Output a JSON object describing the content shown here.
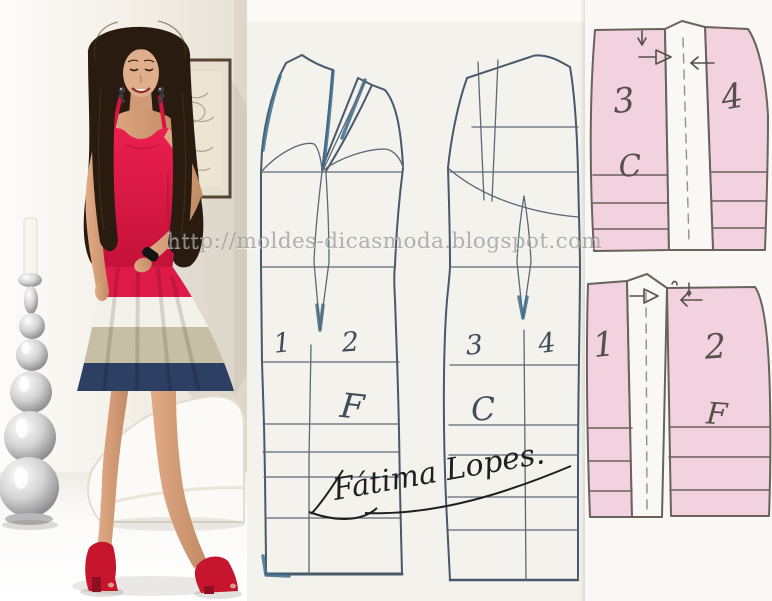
{
  "watermark": {
    "text": "http://moldes-dicasmoda.blogspot.com"
  },
  "signature": {
    "text": "Fátima Lopes."
  },
  "draft": {
    "front": {
      "numbers": [
        "1",
        "2"
      ],
      "label": "F"
    },
    "back": {
      "numbers": [
        "3",
        "4"
      ],
      "label": "C"
    }
  },
  "pieces": {
    "back_skirt": {
      "numbers": [
        "3",
        "4"
      ],
      "label": "C"
    },
    "front_skirt": {
      "numbers": [
        "1",
        "2"
      ],
      "label": "F"
    }
  },
  "photo": {
    "dress_band_colors": [
      "#de1a48",
      "#f4f1ea",
      "#c7bfa5",
      "#2d3f63"
    ],
    "shoe_color": "#c8152e"
  },
  "colors": {
    "piece_pink": "#f3d2e0",
    "pencil_blue": "#47596b",
    "pencil_heavy_blue": "#3f6d8c",
    "paper": "#f4f2ec"
  }
}
